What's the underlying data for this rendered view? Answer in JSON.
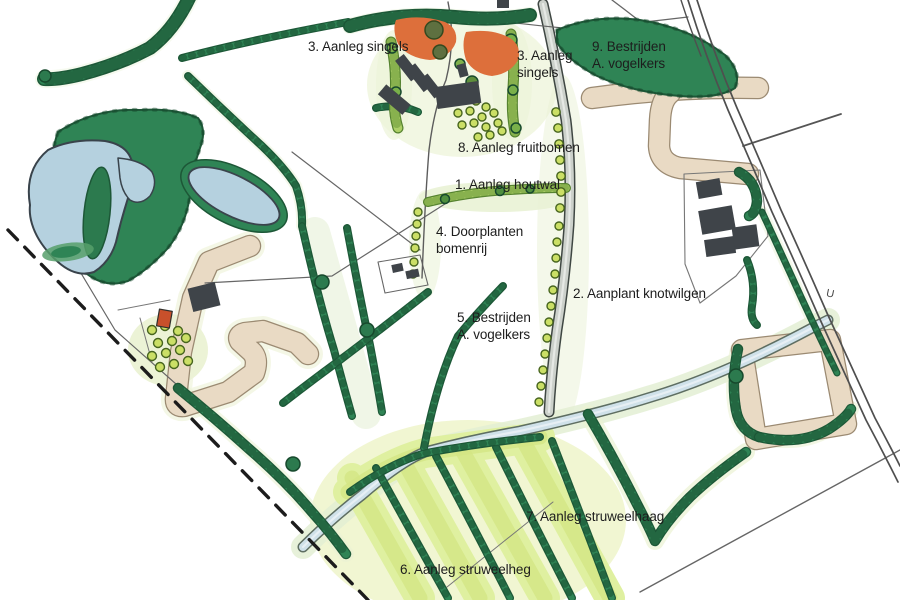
{
  "map": {
    "labels": [
      {
        "id": "singels-west",
        "text": "3. Aanleg singels"
      },
      {
        "id": "singels-mid",
        "text": "3. Aanleg\nsingels"
      },
      {
        "id": "bestrijden-noord",
        "text": "9. Bestrijden\nA. vogelkers"
      },
      {
        "id": "fruitbomen",
        "text": "8. Aanleg fruitbomen"
      },
      {
        "id": "houtwal",
        "text": "1. Aanleg houtwal"
      },
      {
        "id": "doorplanten",
        "text": "4. Doorplanten\nbomenrij"
      },
      {
        "id": "knotwilgen",
        "text": "2. Aanplant knotwilgen"
      },
      {
        "id": "bestrijden-zuid",
        "text": "5. Bestrijden\nA. vogelkers"
      },
      {
        "id": "struweelhaag",
        "text": "7. Aanleg struweelhaag"
      },
      {
        "id": "struweelheg",
        "text": "6. Aanleg struweelheg"
      },
      {
        "id": "road-letter",
        "text": "U"
      }
    ],
    "palette": {
      "forest_green": "#2f8455",
      "hedge_dark": "#1e5a39",
      "light_hedge_green": "#accf67",
      "strip_yellow_green": "#dff0a0",
      "pond_blue": "#b5d1df",
      "stream_blue": "#ccdfe8",
      "track_beige": "#e9dac4",
      "building_gray": "#3f4449",
      "roof_orange": "#dd6f3b",
      "shed_red": "#c8502b",
      "boundary_black": "#1c1c1c"
    },
    "features": [
      "forest-with-ponds",
      "small-pond",
      "stream",
      "central-lane",
      "country-road",
      "farmstead-north",
      "farmstead-east",
      "beige-farm-tracks",
      "dashed-plan-boundary",
      "orchards",
      "tree-rows",
      "shrub-strips",
      "knotwilg-row",
      "fruit-tree-row"
    ]
  }
}
